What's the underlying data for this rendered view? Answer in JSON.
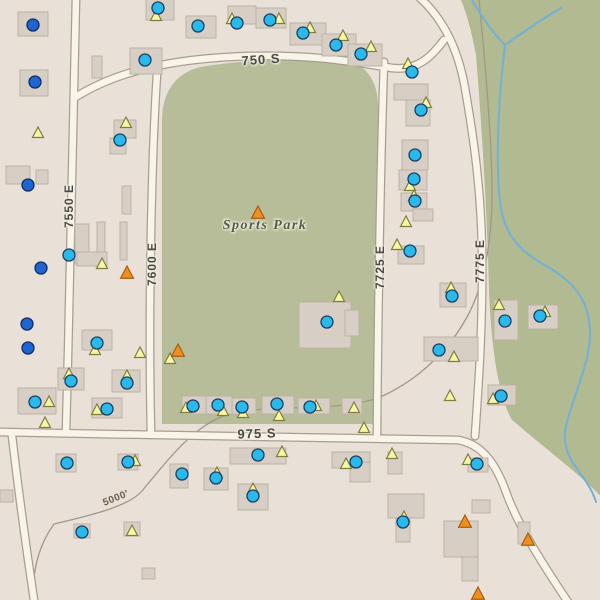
{
  "map": {
    "labels": {
      "place": "Sports Park",
      "street_750s": "750 S",
      "street_975s": "975 S",
      "street_7550e": "7550 E",
      "street_7600e": "7600 E",
      "street_7725e": "7725 E",
      "street_7775e": "7775 E",
      "contour_elevation": "5000'"
    },
    "colors": {
      "background": "#e9e1d7",
      "park_green": "#b7bd99",
      "natural_green": "#b1ba90",
      "road_fill": "#f8f4ea",
      "road_casing": "#a89e90",
      "building_fill": "#d7cfc5",
      "building_stroke": "#bdb2a4",
      "stream": "#72b0d8",
      "contour": "#a3968a",
      "marker_cyan": "#29b9ea",
      "marker_cyan_stroke": "#1b3f63",
      "marker_blue": "#2064d2",
      "marker_blue_stroke": "#102e60",
      "marker_yellow": "#f6f6a6",
      "marker_yellow_stroke": "#7e7e3c",
      "marker_orange": "#ef8f1f",
      "marker_orange_stroke": "#a85c12",
      "street_text": "#4b4943",
      "park_text": "#4f5e42",
      "contour_text": "#6a5d4f"
    },
    "geometry": {
      "green_area": "M461,0 L602,0 L602,498 C588,481 552,454 512,420 C497,394 491,340 489,290 C487,210 482,130 476,55 C472,34 467,14 461,0 Z",
      "park": "M162,424 L162,120 C162,90 178,70 206,66 C250,60 300,56 330,57 C360,59 377,74 378,104 L378,424 Z",
      "contour": "M479,0 C485,60 491,130 492,185 C493,242 483,288 467,317 C449,350 418,381 378,398 C330,414 258,402 221,417 C190,430 166,462 142,491 C128,507 88,516 54,524 C38,546 32,572 33,602",
      "streams": [
        "M471,-2 C480,14 492,32 505,45",
        "M561,8 C544,18 522,33 505,45",
        "M505,45 C499,95 496,145 499,192 C501,228 514,247 541,263 C572,280 589,298 590,331 C591,362 574,392 566,426 C559,461 587,472 596,502"
      ],
      "roads": [
        "M76,-2 C74,120 70,280 66,432",
        "M12,436 C16,470 22,520 34,600",
        "M158,60 C152,140 148,300 151,434",
        "M384,62 C381,150 378,300 377,434",
        "M74,98 C115,72 170,58 252,56 C320,55 352,62 392,68 C418,71 432,56 444,40",
        "M420,-2 C442,18 458,48 465,88 C474,140 481,190 482,250 C483,320 479,380 475,436",
        "M-2,432 C150,435 300,438 458,440 C482,444 496,464 506,492 C518,526 544,566 568,602"
      ],
      "buildings": [
        [
          146,
          -2,
          28,
          22
        ],
        [
          186,
          16,
          30,
          22
        ],
        [
          228,
          6,
          28,
          18
        ],
        [
          256,
          8,
          30,
          20
        ],
        [
          290,
          23,
          36,
          22
        ],
        [
          322,
          34,
          34,
          22
        ],
        [
          348,
          44,
          34,
          22
        ],
        [
          130,
          48,
          32,
          26
        ],
        [
          394,
          84,
          34,
          16
        ],
        [
          406,
          100,
          24,
          26
        ],
        [
          402,
          140,
          26,
          30
        ],
        [
          399,
          170,
          28,
          20
        ],
        [
          401,
          193,
          26,
          18
        ],
        [
          413,
          209,
          20,
          12
        ],
        [
          398,
          246,
          26,
          18
        ],
        [
          440,
          283,
          26,
          24
        ],
        [
          494,
          300,
          24,
          40
        ],
        [
          528,
          305,
          30,
          24
        ],
        [
          424,
          337,
          54,
          24
        ],
        [
          488,
          385,
          28,
          20
        ],
        [
          18,
          12,
          30,
          24
        ],
        [
          20,
          70,
          28,
          26
        ],
        [
          6,
          166,
          24,
          18
        ],
        [
          36,
          170,
          12,
          14
        ],
        [
          92,
          56,
          10,
          22
        ],
        [
          114,
          120,
          22,
          18
        ],
        [
          110,
          138,
          16,
          16
        ],
        [
          122,
          186,
          9,
          28
        ],
        [
          120,
          222,
          7,
          38
        ],
        [
          97,
          222,
          8,
          40
        ],
        [
          75,
          224,
          14,
          40
        ],
        [
          77,
          252,
          30,
          14
        ],
        [
          82,
          330,
          30,
          20
        ],
        [
          58,
          368,
          26,
          22
        ],
        [
          112,
          370,
          28,
          22
        ],
        [
          18,
          388,
          38,
          26
        ],
        [
          92,
          398,
          30,
          20
        ],
        [
          182,
          396,
          24,
          18
        ],
        [
          206,
          396,
          26,
          18
        ],
        [
          232,
          398,
          24,
          16
        ],
        [
          262,
          396,
          32,
          18
        ],
        [
          298,
          398,
          32,
          16
        ],
        [
          342,
          398,
          20,
          16
        ],
        [
          299,
          302,
          52,
          46
        ],
        [
          345,
          310,
          14,
          26
        ],
        [
          230,
          448,
          56,
          16
        ],
        [
          204,
          468,
          24,
          22
        ],
        [
          170,
          464,
          18,
          24
        ],
        [
          238,
          484,
          30,
          26
        ],
        [
          332,
          452,
          38,
          16
        ],
        [
          350,
          462,
          20,
          20
        ],
        [
          388,
          452,
          14,
          22
        ],
        [
          468,
          458,
          20,
          14
        ],
        [
          388,
          494,
          36,
          24
        ],
        [
          396,
          518,
          14,
          24
        ],
        [
          472,
          500,
          18,
          13
        ],
        [
          444,
          521,
          34,
          36
        ],
        [
          462,
          557,
          16,
          24
        ],
        [
          74,
          524,
          16,
          14
        ],
        [
          124,
          522,
          16,
          14
        ],
        [
          142,
          568,
          13,
          11
        ],
        [
          0,
          490,
          13,
          12
        ],
        [
          518,
          522,
          12,
          22
        ],
        [
          56,
          454,
          20,
          18
        ],
        [
          118,
          454,
          20,
          16
        ]
      ],
      "markers_cyan": [
        [
          158,
          8
        ],
        [
          198,
          26
        ],
        [
          237,
          23
        ],
        [
          270,
          20
        ],
        [
          303,
          33
        ],
        [
          336,
          45
        ],
        [
          361,
          54
        ],
        [
          145,
          60
        ],
        [
          412,
          72
        ],
        [
          421,
          110
        ],
        [
          415,
          155
        ],
        [
          414,
          179
        ],
        [
          415,
          201
        ],
        [
          410,
          251
        ],
        [
          120,
          140
        ],
        [
          69,
          255
        ],
        [
          327,
          322
        ],
        [
          452,
          296
        ],
        [
          505,
          321
        ],
        [
          540,
          316
        ],
        [
          439,
          350
        ],
        [
          501,
          396
        ],
        [
          97,
          343
        ],
        [
          127,
          383
        ],
        [
          71,
          381
        ],
        [
          35,
          402
        ],
        [
          107,
          409
        ],
        [
          193,
          406
        ],
        [
          218,
          405
        ],
        [
          242,
          407
        ],
        [
          277,
          404
        ],
        [
          310,
          407
        ],
        [
          258,
          455
        ],
        [
          216,
          478
        ],
        [
          182,
          474
        ],
        [
          253,
          496
        ],
        [
          356,
          462
        ],
        [
          477,
          464
        ],
        [
          403,
          522
        ],
        [
          67,
          463
        ],
        [
          128,
          462
        ],
        [
          82,
          532
        ]
      ],
      "markers_blue": [
        [
          33,
          25
        ],
        [
          35,
          82
        ],
        [
          28,
          185
        ],
        [
          41,
          268
        ],
        [
          27,
          324
        ],
        [
          28,
          348
        ]
      ],
      "markers_yellow": [
        [
          156,
          16
        ],
        [
          232,
          19
        ],
        [
          279,
          19
        ],
        [
          310,
          28
        ],
        [
          343,
          36
        ],
        [
          371,
          47
        ],
        [
          408,
          64
        ],
        [
          426,
          103
        ],
        [
          410,
          186
        ],
        [
          414,
          196
        ],
        [
          406,
          222
        ],
        [
          397,
          245
        ],
        [
          451,
          288
        ],
        [
          499,
          305
        ],
        [
          545,
          312
        ],
        [
          454,
          357
        ],
        [
          450,
          396
        ],
        [
          493,
          399
        ],
        [
          339,
          297
        ],
        [
          126,
          123
        ],
        [
          102,
          264
        ],
        [
          38,
          133
        ],
        [
          95,
          350
        ],
        [
          140,
          353
        ],
        [
          69,
          374
        ],
        [
          127,
          376
        ],
        [
          49,
          402
        ],
        [
          97,
          410
        ],
        [
          45,
          423
        ],
        [
          170,
          359
        ],
        [
          186,
          408
        ],
        [
          223,
          411
        ],
        [
          243,
          413
        ],
        [
          279,
          416
        ],
        [
          316,
          406
        ],
        [
          354,
          408
        ],
        [
          364,
          428
        ],
        [
          282,
          452
        ],
        [
          217,
          473
        ],
        [
          253,
          489
        ],
        [
          346,
          464
        ],
        [
          392,
          454
        ],
        [
          468,
          460
        ],
        [
          404,
          517
        ],
        [
          135,
          461
        ],
        [
          132,
          531
        ]
      ],
      "markers_orange": [
        [
          258,
          213
        ],
        [
          127,
          273
        ],
        [
          178,
          351
        ],
        [
          465,
          522
        ],
        [
          528,
          540
        ],
        [
          478,
          594
        ]
      ]
    }
  }
}
